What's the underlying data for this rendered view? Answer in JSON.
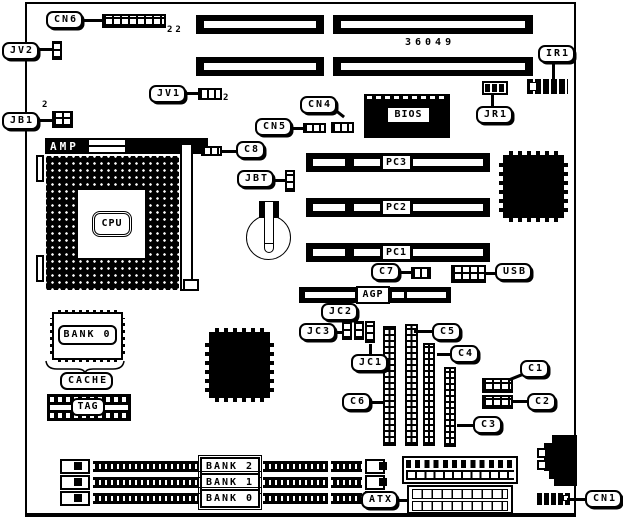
{
  "diagram_title": "motherboard-layout",
  "board_number": "36049",
  "colors": {
    "ink": "#000000",
    "background": "#ffffff"
  },
  "labels": {
    "cn6": "CN6",
    "cn6_pins": "22",
    "jv2": "JV2",
    "jb1": "JB1",
    "jb1_pin": "2",
    "jv1": "JV1",
    "jv1_pin": "2",
    "cn4": "CN4",
    "cn5": "CN5",
    "c8": "C8",
    "jbt": "JBT",
    "bios": "BIOS",
    "ir1": "IR1",
    "jr1": "JR1",
    "pc3": "PC3",
    "pc2": "PC2",
    "pc1": "PC1",
    "amp": "AMP",
    "cpu": "CPU",
    "c7": "C7",
    "usb": "USB",
    "agp": "AGP",
    "jc2": "JC2",
    "jc3": "JC3",
    "jc1": "JC1",
    "c6": "C6",
    "c5": "C5",
    "c4": "C4",
    "c3": "C3",
    "c1": "C1",
    "c2": "C2",
    "bank0_chip": "BANK 0",
    "cache": "CACHE",
    "tag": "TAG",
    "bank2": "BANK 2",
    "bank1": "BANK 1",
    "bank0": "BANK 0",
    "atx": "ATX",
    "cn1": "CN1"
  }
}
